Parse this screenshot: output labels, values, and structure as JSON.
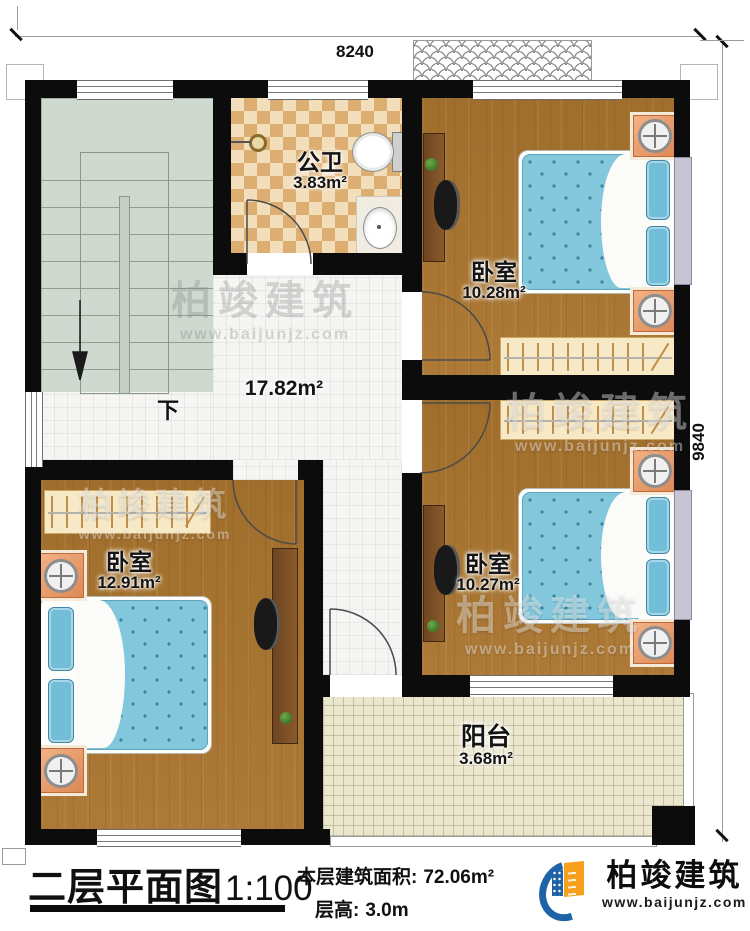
{
  "sheet": {
    "title": "二层平面图",
    "scale": "1:100",
    "area_label": "本层建筑面积:",
    "area_value": "72.06m²",
    "floor_height_label": "层高:",
    "floor_height_value": "3.0m"
  },
  "brand": {
    "name": "柏竣建筑",
    "url": "www.baijunjz.com",
    "blue": "#1e63a8",
    "orange": "#f6a01b"
  },
  "dimensions": {
    "top": "8240",
    "right": "9840"
  },
  "rooms": {
    "bathroom": {
      "name": "公卫",
      "area": "3.83m²"
    },
    "bedroom_top_right": {
      "name": "卧室",
      "area": "10.28m²"
    },
    "bedroom_middle_right": {
      "name": "卧室",
      "area": "10.27m²"
    },
    "bedroom_bottom_left": {
      "name": "卧室",
      "area": "12.91m²"
    },
    "hallway": {
      "area": "17.82m²"
    },
    "balcony": {
      "name": "阳台",
      "area": "3.68m²"
    }
  },
  "stair": {
    "down_label": "下"
  },
  "watermark": {
    "text": "柏竣建筑",
    "url": "www.baijunjz.com"
  },
  "colors": {
    "wall": "#0c0c0c",
    "wood_floor": "#a9742e",
    "bed_blue": "#7cc4da",
    "stair_green": "#cfd9cf",
    "bath_tile": "#dcae72",
    "balcony_tile": "#ebe7cf"
  }
}
